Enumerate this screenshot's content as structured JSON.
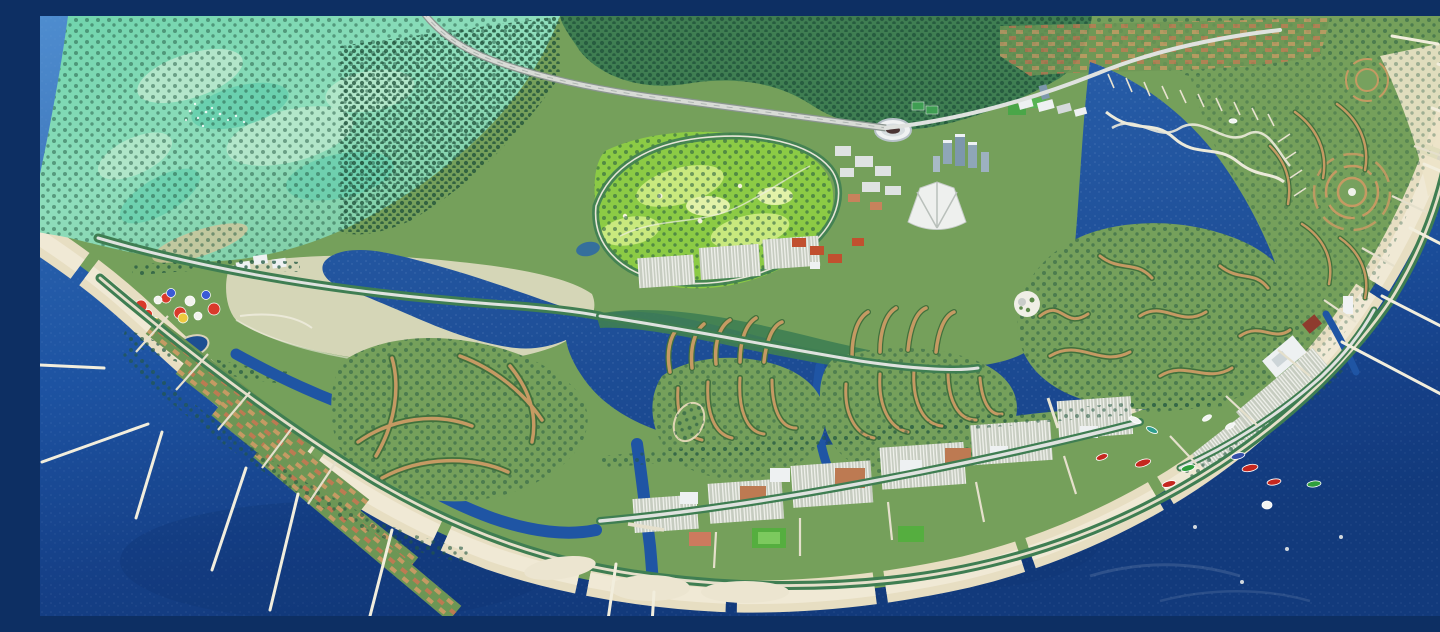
{
  "meta": {
    "title": "Aerial 3D master-plan rendering of a crescent-shaped coastal city: mangrove wetland, golf course, stadium district, canal-island residential clusters in a deep blue lagoon, beachfront arc with piers, marina and boats",
    "image_type": "architectural-visualization, no text or UI elements visible"
  },
  "palette": {
    "ocean_light": "#4284cc",
    "ocean_mid": "#2a63ae",
    "ocean_deep": "#1d53a2",
    "ocean_darkest": "#123a7c",
    "lagoon": "#1f55a4",
    "lagoon_deep": "#1a4890",
    "land_green": "#75a05b",
    "beach": "#e7dec2",
    "beach_light": "#f0e9d5",
    "pier": "#f2eedd",
    "marsh_teal": "#6fd4ac",
    "marsh_light": "#a8e6c8",
    "marsh_pale": "#bfe9cf",
    "marsh_aqua": "#5eccab",
    "forest": "#3f7e52",
    "forest_dark": "#2b5c3e",
    "tree_dark": "#225741",
    "golf_green": "#8ccb45",
    "golf_light": "#c9e97e",
    "golf_pale": "#e2f2a8",
    "road": "#dfe2df",
    "road_sand": "#e5dfca",
    "rooftop_tan": "#c59a63",
    "rooftop_terracotta": "#bd7a52",
    "building_white": "#eef1f2",
    "building_gray": "#c3cdd3",
    "tower_blue": "#7d97ac",
    "field_green": "#55ae3f",
    "court_salmon": "#cc7a5e",
    "plaza": "#e6dfc8",
    "pond_navy": "#1d4f92",
    "tent_red": "#d93a2b",
    "tent_yellow": "#eec93e",
    "tent_blue": "#3b5bd6",
    "tent_white": "#f2f3ee",
    "boat_red": "#c5271f",
    "boat_green": "#2e9e3c",
    "boat_blue": "#3550a8",
    "boat_teal": "#2e9e8e",
    "boat_white": "#f2f4f2"
  },
  "scene": {
    "regions": [
      "ocean",
      "mangrove-wetland",
      "forest-belt",
      "highway",
      "golf-course",
      "stadium",
      "high-rise-towers",
      "sail-pavilion",
      "theme-park",
      "lagoon",
      "canal-island-clusters",
      "palm-finger-homes",
      "circular-village",
      "beachfront-residences",
      "commercial-grid",
      "marina-docks",
      "twin-braided-bridges",
      "beach-coves",
      "piers",
      "boats"
    ],
    "boats": [
      {
        "x": 1103,
        "y": 447,
        "rot": -18,
        "color": "boat_red",
        "len": 8,
        "wid": 3.4
      },
      {
        "x": 1129,
        "y": 468,
        "rot": -15,
        "color": "boat_red",
        "len": 7,
        "wid": 3
      },
      {
        "x": 1210,
        "y": 452,
        "rot": -12,
        "color": "boat_red",
        "len": 8,
        "wid": 3.4
      },
      {
        "x": 1234,
        "y": 466,
        "rot": -10,
        "color": "boat_red",
        "len": 7,
        "wid": 3
      },
      {
        "x": 1062,
        "y": 441,
        "rot": -20,
        "color": "boat_red",
        "len": 6,
        "wid": 2.8
      },
      {
        "x": 1148,
        "y": 452,
        "rot": -15,
        "color": "boat_green",
        "len": 7,
        "wid": 3
      },
      {
        "x": 1274,
        "y": 468,
        "rot": -8,
        "color": "boat_green",
        "len": 7,
        "wid": 3
      },
      {
        "x": 1198,
        "y": 440,
        "rot": -15,
        "color": "boat_blue",
        "len": 7,
        "wid": 3
      },
      {
        "x": 1227,
        "y": 489,
        "rot": 0,
        "color": "boat_white",
        "len": 5,
        "wid": 4
      },
      {
        "x": 1095,
        "y": 404,
        "rot": 25,
        "color": "boat_white",
        "len": 6,
        "wid": 2.6
      },
      {
        "x": 1112,
        "y": 414,
        "rot": 25,
        "color": "boat_teal",
        "len": 6,
        "wid": 2.6
      },
      {
        "x": 1167,
        "y": 402,
        "rot": -30,
        "color": "boat_white",
        "len": 5,
        "wid": 2.4
      },
      {
        "x": 1190,
        "y": 410,
        "rot": -30,
        "color": "boat_white",
        "len": 5,
        "wid": 2.4
      },
      {
        "x": 1193,
        "y": 105,
        "rot": 0,
        "color": "boat_white",
        "len": 4,
        "wid": 2.2
      }
    ],
    "piers": [
      {
        "x1": 64,
        "y1": 352,
        "x2": -20,
        "y2": 348
      },
      {
        "x1": 108,
        "y1": 408,
        "x2": 2,
        "y2": 446
      },
      {
        "x1": 122,
        "y1": 416,
        "x2": 96,
        "y2": 502
      },
      {
        "x1": 206,
        "y1": 452,
        "x2": 172,
        "y2": 554
      },
      {
        "x1": 258,
        "y1": 478,
        "x2": 230,
        "y2": 594
      },
      {
        "x1": 352,
        "y1": 514,
        "x2": 330,
        "y2": 600
      },
      {
        "x1": 576,
        "y1": 548,
        "x2": 566,
        "y2": 618
      },
      {
        "x1": 614,
        "y1": 576,
        "x2": 610,
        "y2": 640
      },
      {
        "x1": 1302,
        "y1": 326,
        "x2": 1416,
        "y2": 386
      },
      {
        "x1": 1342,
        "y1": 280,
        "x2": 1440,
        "y2": 330
      },
      {
        "x1": 1370,
        "y1": 212,
        "x2": 1440,
        "y2": 248
      },
      {
        "x1": 1384,
        "y1": 148,
        "x2": 1440,
        "y2": 172
      },
      {
        "x1": 1392,
        "y1": 92,
        "x2": 1440,
        "y2": 110
      },
      {
        "x1": 1398,
        "y1": 48,
        "x2": 1440,
        "y2": 60
      },
      {
        "x1": 1352,
        "y1": 20,
        "x2": 1398,
        "y2": 28
      }
    ],
    "park_tents": [
      {
        "x": 101,
        "y": 290,
        "r": 6,
        "color": "tent_red"
      },
      {
        "x": 126,
        "y": 282,
        "r": 5,
        "color": "tent_red"
      },
      {
        "x": 140,
        "y": 297,
        "r": 6,
        "color": "tent_red"
      },
      {
        "x": 174,
        "y": 293,
        "r": 6,
        "color": "tent_red"
      },
      {
        "x": 108,
        "y": 298,
        "r": 4.5,
        "color": "tent_red"
      },
      {
        "x": 143,
        "y": 302,
        "r": 5,
        "color": "tent_yellow"
      },
      {
        "x": 115,
        "y": 306,
        "r": 4.5,
        "color": "tent_yellow"
      },
      {
        "x": 131,
        "y": 277,
        "r": 4.5,
        "color": "tent_blue"
      },
      {
        "x": 166,
        "y": 279,
        "r": 4.5,
        "color": "tent_blue"
      },
      {
        "x": 150,
        "y": 285,
        "r": 5,
        "color": "tent_white"
      },
      {
        "x": 118,
        "y": 284,
        "r": 4,
        "color": "tent_white"
      },
      {
        "x": 158,
        "y": 300,
        "r": 4,
        "color": "tent_white"
      }
    ],
    "buoys": [
      {
        "x": 1247,
        "y": 533
      },
      {
        "x": 1202,
        "y": 566
      },
      {
        "x": 1155,
        "y": 511
      },
      {
        "x": 1301,
        "y": 521
      }
    ]
  }
}
